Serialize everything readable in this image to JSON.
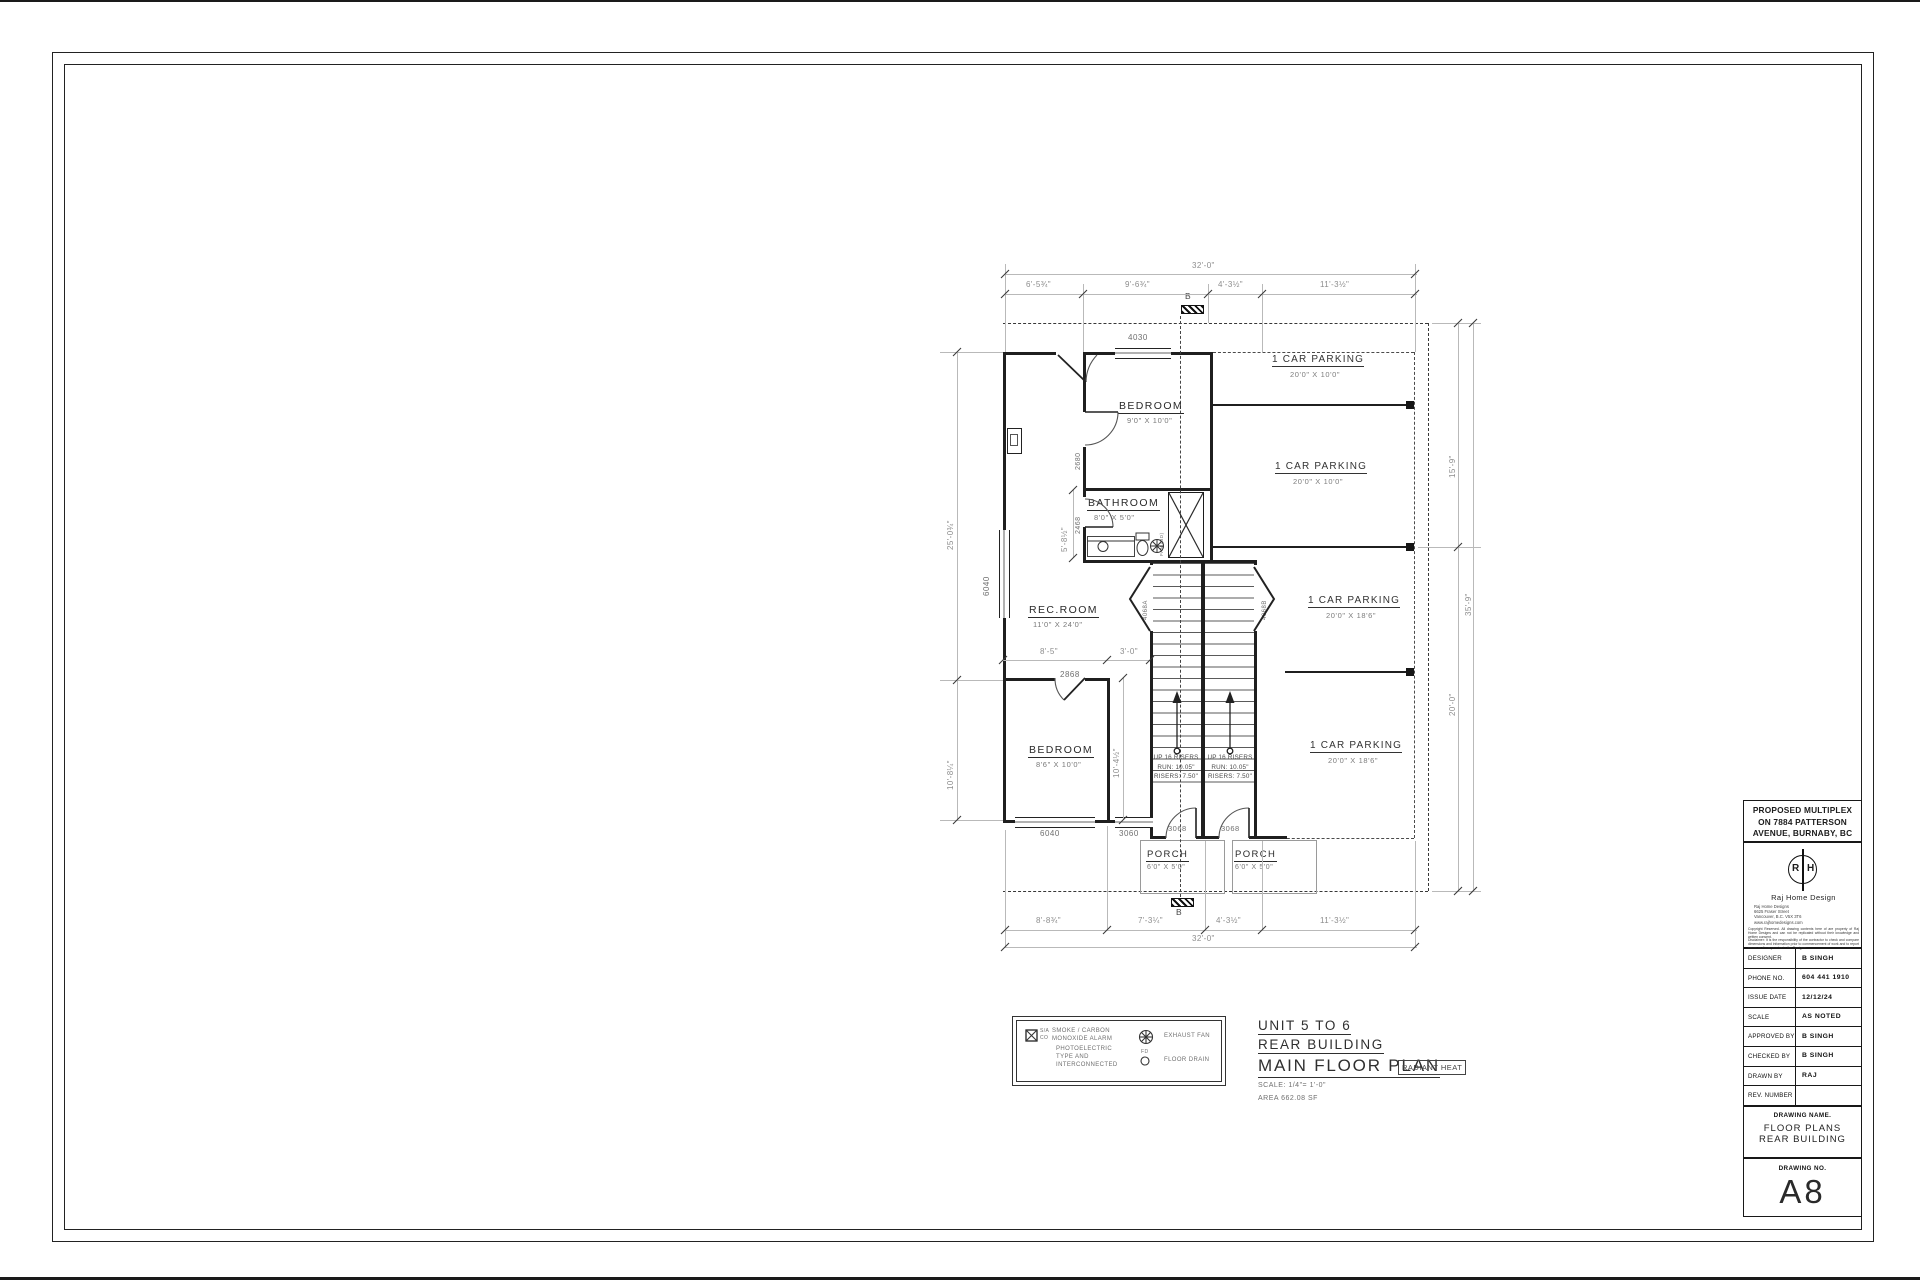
{
  "plan": {
    "rooms": {
      "bed1": {
        "name": "BEDROOM",
        "size": "9'0\" X 10'0\""
      },
      "bath": {
        "name": "BATHROOM",
        "size": "8'0\" X 5'0\""
      },
      "rec": {
        "name": "REC.ROOM",
        "size": "11'0\" X 24'0\""
      },
      "bed2": {
        "name": "BEDROOM",
        "size": "8'6\" X 10'0\""
      },
      "porch1": {
        "name": "PORCH",
        "size": "6'0\" X 5'0\""
      },
      "porch2": {
        "name": "PORCH",
        "size": "6'0\" X 5'0\""
      }
    },
    "parking": [
      {
        "name": "1 CAR PARKING",
        "size": "20'0\" X 10'0\""
      },
      {
        "name": "1 CAR PARKING",
        "size": "20'0\" X 10'0\""
      },
      {
        "name": "1 CAR PARKING",
        "size": "20'0\" X 18'6\""
      },
      {
        "name": "1 CAR PARKING",
        "size": "20'0\" X 18'6\""
      }
    ],
    "stairs": {
      "lines": [
        "UP 16 RISERS",
        "RUN: 10.05\"",
        "RISERS: 7.50\""
      ]
    },
    "fan_note": "FAN (BD)",
    "section_label": "B",
    "openings": {
      "win_top": "4030",
      "win_left": "6040",
      "win_bottom_left": "6040",
      "win_bottom_mid": "3060",
      "door_bed1": "2680",
      "door_bath": "2468",
      "door_bed2": "2868",
      "door_porch_left": "3068",
      "door_porch_right": "3068",
      "door_stair_left": "4068A",
      "door_stair_right": "4068B"
    },
    "dims": {
      "top_total": "32'-0\"",
      "top_segments": [
        "6'-5¾\"",
        "9'-6¾\"",
        "4'-3½\"",
        "11'-3½\""
      ],
      "bottom_segments": [
        "8'-8¾\"",
        "7'-3¼\"",
        "4'-3½\"",
        "11'-3½\""
      ],
      "bottom_total": "32'-0\"",
      "left_upper": "25'-0¾\"",
      "left_lower": "10'-8¼\"",
      "right_upper": "15'-9\"",
      "right_lower": "20'-0\"",
      "right_total": "35'-9\"",
      "rec_a": "8'-5\"",
      "rec_b": "3'-0\"",
      "bed2_height": "10'-4½\"",
      "bath_height": "5'-8½\""
    }
  },
  "legend": {
    "sa": "S/A",
    "co": "CO",
    "smoke_lines": [
      "SMOKE / CARBON",
      "MONOXIDE ALARM",
      "PHOTOELECTRIC",
      "TYPE AND",
      "INTERCONNECTED"
    ],
    "fan": "EXHAUST FAN",
    "fd": "FD",
    "drain": "FLOOR DRAIN"
  },
  "title": {
    "unit": "UNIT 5 TO 6",
    "building": "REAR BUILDING",
    "plan": "MAIN FLOOR PLAN",
    "badge": "RADIANT HEAT",
    "scale": "SCALE: 1/4\"= 1'-0\"",
    "area": "AREA  662.08 SF"
  },
  "title_block": {
    "project_lines": [
      "PROPOSED MULTIPLEX",
      "ON 7884 PATTERSON",
      "AVENUE, BURNABY, BC"
    ],
    "firm": {
      "logo_left": "R",
      "logo_right": "H",
      "name": "Raj Home Design",
      "address_lines": [
        "Raj Home Designs",
        "6625 Fraser Street",
        "Vancouver, B.C. V5X 3T6",
        "www.rajhomedesigns.com"
      ],
      "copyright": "Copyright Reserved. All drawing contents here of are property of Raj Home Designs and can not be replicated without their knowledge and written consent.",
      "disclaimer": "Disclaimer: It is the responsibility of the contractor to check and compare dimensions and information prior to commencement of work and to report errors or discrepancies to the Designer."
    },
    "rows": [
      {
        "label": "DESIGNER",
        "value": "B SINGH"
      },
      {
        "label": "PHONE NO.",
        "value": "604 441 1910"
      },
      {
        "label": "ISSUE DATE",
        "value": "12/12/24"
      },
      {
        "label": "SCALE",
        "value": "AS NOTED"
      },
      {
        "label": "APPROVED BY",
        "value": "B SINGH"
      },
      {
        "label": "CHECKED BY",
        "value": "B SINGH"
      },
      {
        "label": "DRAWN BY",
        "value": "RAJ"
      },
      {
        "label": "REV. NUMBER",
        "value": ""
      }
    ],
    "drawing_name_label": "DRAWING NAME.",
    "drawing_name_lines": [
      "FLOOR PLANS",
      "REAR BUILDING"
    ],
    "drawing_no_label": "DRAWING NO.",
    "drawing_no": "A8"
  }
}
